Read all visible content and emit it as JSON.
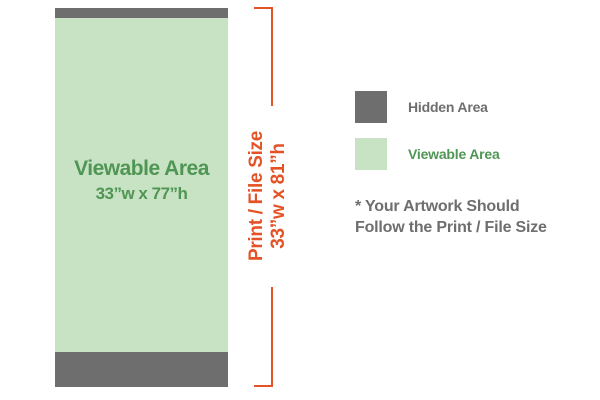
{
  "banner": {
    "viewable_label": "Viewable Area",
    "viewable_size": "33”w x 77”h"
  },
  "bracket": {
    "label": "Print / File Size",
    "size": "33”w x 81”h"
  },
  "legend": {
    "items": [
      {
        "label": "Hidden Area",
        "swatch": "hidden-area-swatch",
        "color": "#6e6e6e"
      },
      {
        "label": "Viewable Area",
        "swatch": "viewable-area-swatch",
        "color": "#c8e2c4"
      }
    ]
  },
  "note": {
    "line1": "* Your Artwork Should",
    "line2": "Follow the Print / File Size"
  },
  "colors": {
    "hidden_area_gray": "#6e6e6e",
    "viewable_area_green": "#c8e2c4",
    "green_text": "#4f9655",
    "bracket_orange": "#e45226",
    "note_gray": "#6e6e6e",
    "background": "#ffffff"
  }
}
